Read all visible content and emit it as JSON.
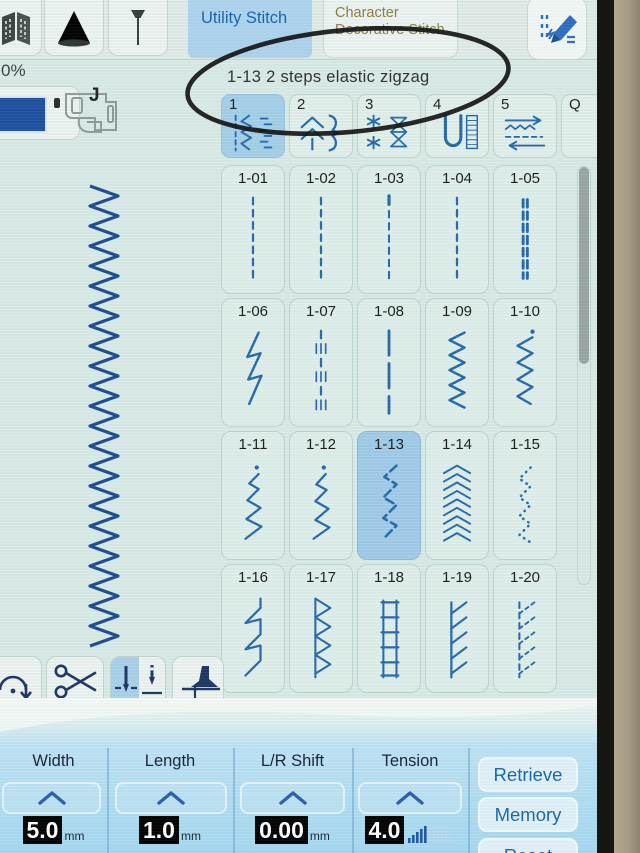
{
  "top_bar": {
    "utility_tab_label": "Utility Stitch",
    "decorative_tab_label": "Character Decorative Stitch",
    "icons": [
      "fabric-icon",
      "thread-cone-icon",
      "pin-icon",
      "stitch-edit-pencil-icon"
    ]
  },
  "annotation_text": "1-13  2 steps elastic zigzag",
  "zoom_indicator": "0%",
  "presser_foot_label": "J",
  "category_tabs": [
    {
      "label": "1",
      "icon": "utility-stitches-icon",
      "selected": true
    },
    {
      "label": "2",
      "icon": "decorative-stitches-icon",
      "selected": false
    },
    {
      "label": "3",
      "icon": "satin-stitches-icon",
      "selected": false
    },
    {
      "label": "4",
      "icon": "buttonhole-stitches-icon",
      "selected": false
    },
    {
      "label": "5",
      "icon": "reverse-arrows-icon",
      "selected": false
    },
    {
      "label": "Q",
      "icon": "quilting-stitches-icon",
      "selected": false
    }
  ],
  "stitch_grid": {
    "selected_id": "1-13",
    "cells": [
      {
        "id": "1-01",
        "glyph": "dashed-straight"
      },
      {
        "id": "1-02",
        "glyph": "dashed-straight"
      },
      {
        "id": "1-03",
        "glyph": "dashed-straight-top"
      },
      {
        "id": "1-04",
        "glyph": "dashed-straight"
      },
      {
        "id": "1-05",
        "glyph": "triple-straight"
      },
      {
        "id": "1-06",
        "glyph": "stretch-stitch"
      },
      {
        "id": "1-07",
        "glyph": "basting"
      },
      {
        "id": "1-08",
        "glyph": "long-dash"
      },
      {
        "id": "1-09",
        "glyph": "zigzag"
      },
      {
        "id": "1-10",
        "glyph": "zigzag-dot"
      },
      {
        "id": "1-11",
        "glyph": "elastic-zigzag-dot"
      },
      {
        "id": "1-12",
        "glyph": "elastic-zigzag-dot2"
      },
      {
        "id": "1-13",
        "glyph": "two-step-elastic-zigzag"
      },
      {
        "id": "1-14",
        "glyph": "triple-zigzag"
      },
      {
        "id": "1-15",
        "glyph": "dotted-zigzag"
      },
      {
        "id": "1-16",
        "glyph": "blind-hem"
      },
      {
        "id": "1-17",
        "glyph": "overcast-triangles"
      },
      {
        "id": "1-18",
        "glyph": "overcast-ladder"
      },
      {
        "id": "1-19",
        "glyph": "overcast-diagonal"
      },
      {
        "id": "1-20",
        "glyph": "overcast-diagonal-dashed"
      }
    ]
  },
  "toolbar": {
    "buttons": [
      {
        "name": "reinforcement-stitch",
        "icon": "reinforce-arc-icon",
        "selected": false
      },
      {
        "name": "thread-cut",
        "icon": "scissors-icon",
        "selected": false
      },
      {
        "name": "needle-position",
        "icon": "needle-up-down-icon",
        "selected_half": "down"
      },
      {
        "name": "presser-foot-lift",
        "icon": "presser-foot-icon",
        "selected": false
      }
    ]
  },
  "settings": {
    "columns": [
      {
        "label": "Width",
        "value": "5.0",
        "unit": "mm"
      },
      {
        "label": "Length",
        "value": "1.0",
        "unit": "mm"
      },
      {
        "label": "L/R Shift",
        "value": "0.00",
        "unit": "mm"
      },
      {
        "label": "Tension",
        "value": "4.0",
        "unit": ""
      }
    ],
    "buttons": [
      {
        "label": "Retrieve"
      },
      {
        "label": "Memory"
      },
      {
        "label": "Reset"
      }
    ]
  },
  "colors": {
    "stitch_blue": "#2468aa",
    "selected_cell": "#9fcbe8",
    "utility_tab_bg": "#aed3ee",
    "decorative_text": "#8c7c3e",
    "panel_blue": "#aedcf2",
    "value_bg": "#000000",
    "annotation_stroke": "#161616"
  }
}
